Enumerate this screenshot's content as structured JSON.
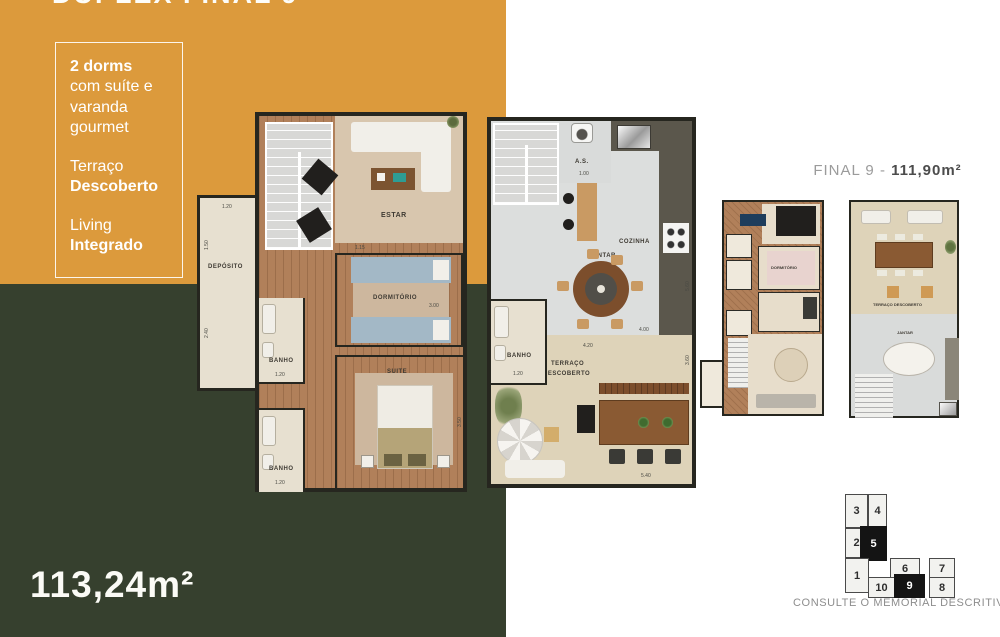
{
  "meta": {
    "cropped_title": "DUPLEX FINAL 9"
  },
  "colors": {
    "orange": "#DC9A3C",
    "green": "#36402E",
    "wall": "#26261F"
  },
  "info_box": {
    "headline_bold": "2 dorms",
    "headline_rest": "com suíte e varanda gourmet",
    "feature1_normal": "Terraço",
    "feature1_bold": "Descoberto",
    "feature2_normal": "Living",
    "feature2_bold": "Integrado"
  },
  "area_badge": "113,24m²",
  "unit_label": {
    "prefix": "FINAL 9 - ",
    "area_bold": "111,90m²"
  },
  "plan_lower": {
    "rooms": {
      "estar": "ESTAR",
      "dormitorio": "DORMITÓRIO",
      "suite": "SUITE",
      "banho1": "BANHO",
      "banho2": "BANHO",
      "deposito": "DEPÓSITO"
    },
    "dims": [
      "1.20",
      "2.40",
      "1.50",
      "1.15",
      "3.00",
      "1.20",
      "3.50",
      "1.20"
    ]
  },
  "plan_upper": {
    "rooms": {
      "as": "A.S.",
      "cozinha": "COZINHA",
      "jantar": "JANTAR",
      "banho": "BANHO",
      "terraco1": "TERRAÇO",
      "terraco2": "DESCOBERTO"
    },
    "dims": [
      "1.00",
      "1.20",
      "4.20",
      "4.00",
      "3.60",
      "5.40",
      "5.60"
    ]
  },
  "mini_lower": {
    "label_dormitorio": "DORMITÓRIO"
  },
  "mini_upper": {
    "label_terraco": "TERRAÇO DESCOBERTO",
    "label_jantar": "JANTAR"
  },
  "keyplan": {
    "units": [
      {
        "n": "3",
        "highlight": false
      },
      {
        "n": "4",
        "highlight": false
      },
      {
        "n": "2",
        "highlight": false
      },
      {
        "n": "5",
        "highlight": true
      },
      {
        "n": "1",
        "highlight": false
      },
      {
        "n": "6",
        "highlight": false
      },
      {
        "n": "7",
        "highlight": false
      },
      {
        "n": "10",
        "highlight": false
      },
      {
        "n": "9",
        "highlight": true
      },
      {
        "n": "8",
        "highlight": false
      }
    ],
    "caption": "CONSULTE O MEMORIAL DESCRITIVO"
  }
}
